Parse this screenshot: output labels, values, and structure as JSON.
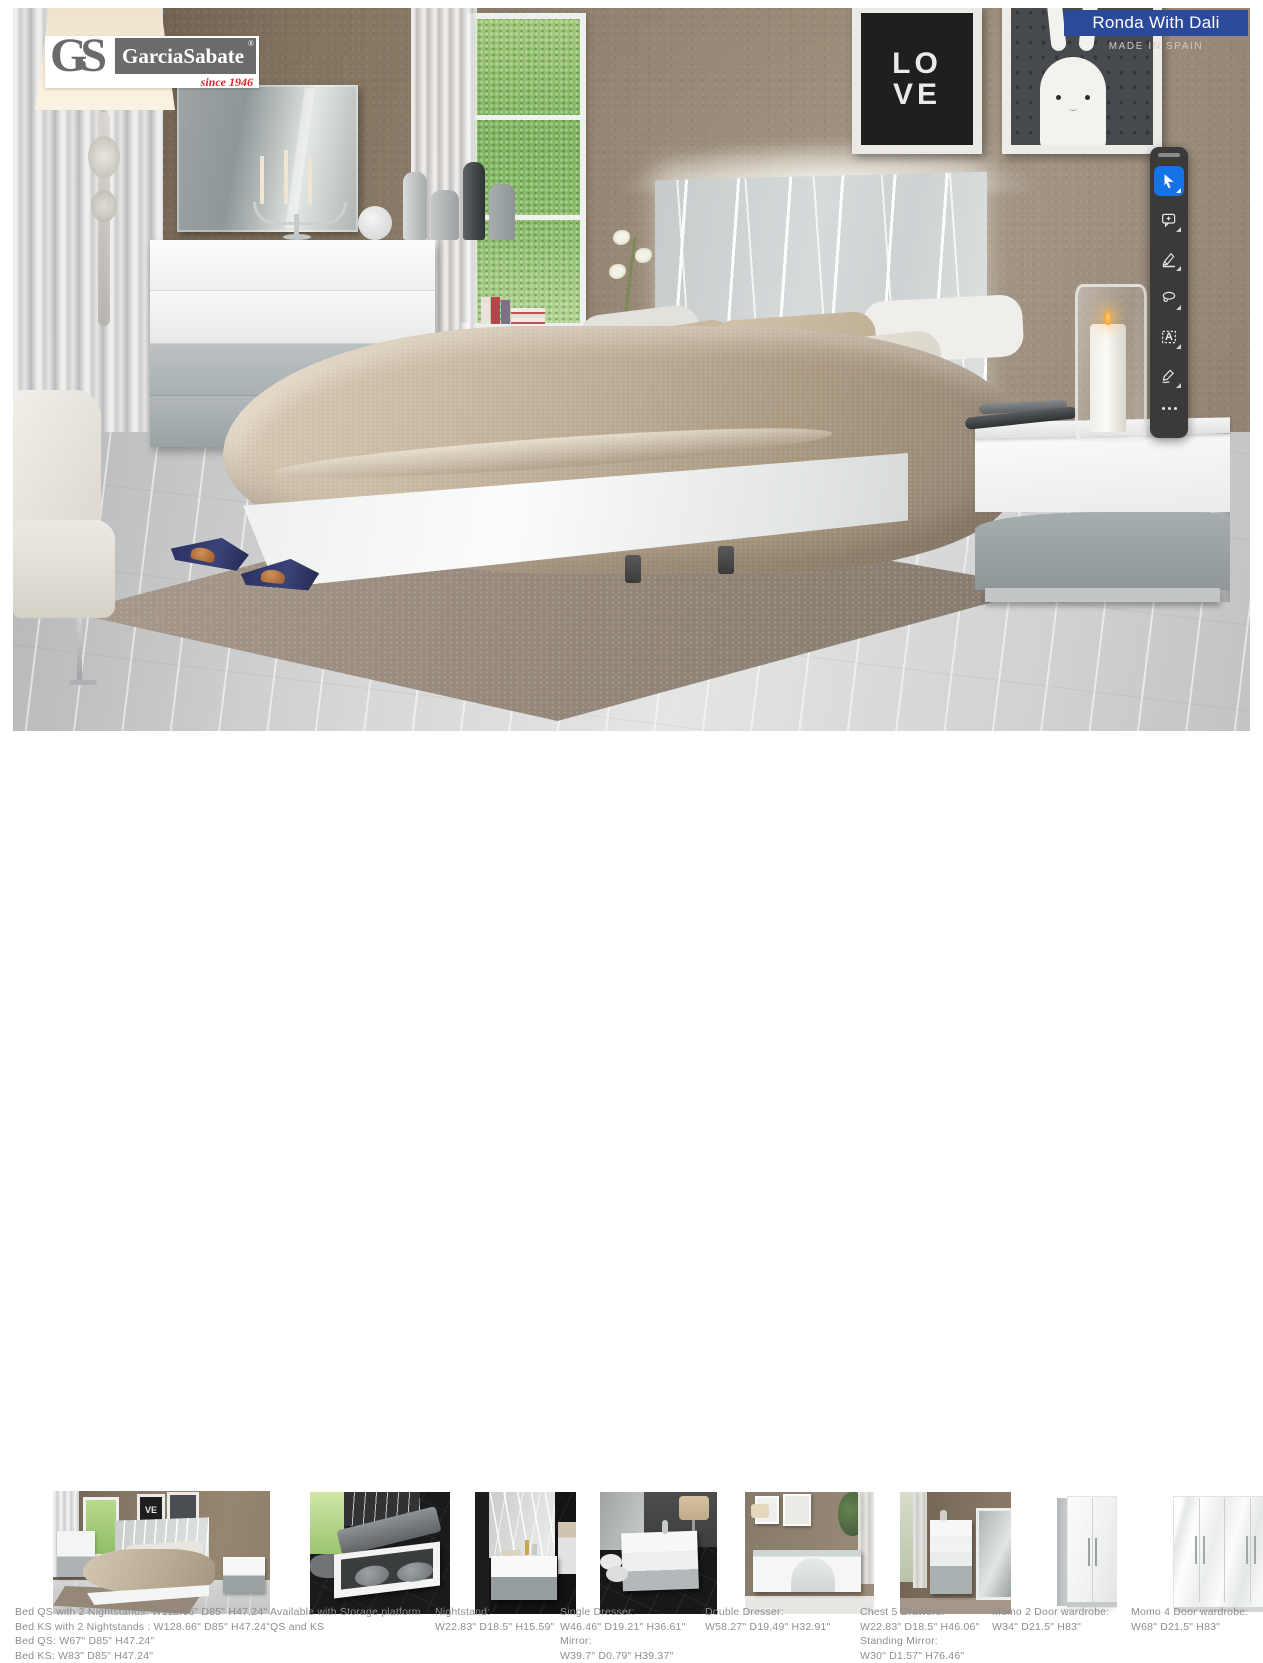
{
  "banner": {
    "title": "Ronda With Dali",
    "subtitle": "MADE IN SPAIN",
    "background_color": "#2b4a99",
    "text_color": "#ffffff"
  },
  "brand": {
    "initials": "GS",
    "name": "GarciaSabate",
    "registered_mark": "®",
    "tagline": "since 1946",
    "tagline_color": "#d8262c"
  },
  "toolbar": {
    "background_color": "#3a3a3a",
    "selected_color": "#1473e6",
    "tools": [
      {
        "name": "select",
        "selected": true
      },
      {
        "name": "add-comment",
        "selected": false
      },
      {
        "name": "highlight",
        "selected": false
      },
      {
        "name": "lasso",
        "selected": false
      },
      {
        "name": "select-text",
        "selected": false,
        "glyph": "A"
      },
      {
        "name": "fill-and-sign",
        "selected": false
      },
      {
        "name": "more-tools",
        "selected": false
      }
    ]
  },
  "artwork": {
    "love_line1": "LO",
    "love_line2": "VE",
    "thumb_frame_text": "VE"
  },
  "products": [
    {
      "id": "bed",
      "caption": "Bed QS with 2 Nightstands: W112.66\" D85\" H47.24\"\nBed KS with 2 Nightstands : W128.66\" D85\" H47.24\"\nBed QS: W67\" D85\" H47.24\"\nBed KS: W83\" D85\" H47.24\""
    },
    {
      "id": "storage-platform",
      "caption": "Available with Storage platform\nQS and KS"
    },
    {
      "id": "nightstand",
      "caption": "Nightstand:\nW22.83\" D18.5\" H15.59\""
    },
    {
      "id": "single-dresser",
      "caption": "Single Dresser:\nW46.46\" D19.21\" H36.61\"\nMirror:\nW39.7\" D0.79\" H39.37\""
    },
    {
      "id": "double-dresser",
      "caption": "Double Dresser:\nW58.27\" D19.49\" H32.91\""
    },
    {
      "id": "chest-5-drawers",
      "caption": "Chest 5 Drawers:\nW22.83\" D18.5\" H46.06\"\nStanding Mirror:\nW30\" D1.57\" H76.46\""
    },
    {
      "id": "momo-2-door-wardrobe",
      "caption": "Momo 2 Door wardrobe:\nW34\" D21.5\" H83\""
    },
    {
      "id": "momo-4-door-wardrobe",
      "caption": "Momo 4 Door wardrobe:\nW68\" D21.5\" H83\""
    }
  ]
}
